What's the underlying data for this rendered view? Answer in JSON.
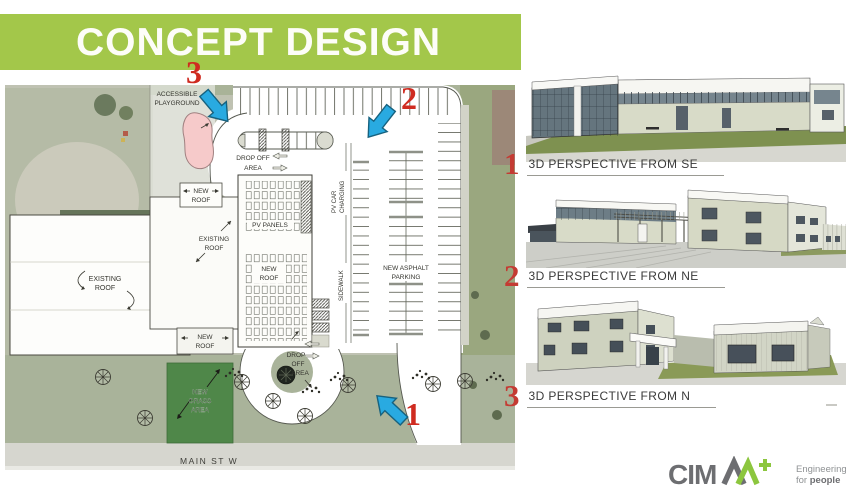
{
  "slide": {
    "title": "CONCEPT DESIGN"
  },
  "site_plan": {
    "street_label": "MAIN ST W",
    "labels": {
      "accessible_playground": [
        "ACCESSIBLE",
        "PLAYGROUND"
      ],
      "drop_off_top": [
        "DROP OFF",
        "AREA"
      ],
      "new_roof_top": [
        "NEW",
        "ROOF"
      ],
      "existing_roof_upper": [
        "EXISTING",
        "ROOF"
      ],
      "existing_roof_main": [
        "EXISTING",
        "ROOF"
      ],
      "pv_panels": "PV PANELS",
      "new_roof_center": [
        "NEW",
        "ROOF"
      ],
      "pv_car_charging": [
        "PV CAR",
        "CHARGING"
      ],
      "sidewalk": "SIDEWALK",
      "new_asphalt_parking": [
        "NEW ASPHALT",
        "PARKING"
      ],
      "new_roof_bottom": [
        "NEW",
        "ROOF"
      ],
      "drop_off_bottom": [
        "DROP",
        "OFF",
        "AREA"
      ],
      "new_grass_area": [
        "NEW",
        "GRASS",
        "AREA"
      ]
    },
    "markers": {
      "one": "1",
      "two": "2",
      "three": "3"
    }
  },
  "perspectives": [
    {
      "number": "1",
      "label": "3D PERSPECTIVE FROM SE"
    },
    {
      "number": "2",
      "label": "3D PERSPECTIVE FROM NE"
    },
    {
      "number": "3",
      "label": "3D PERSPECTIVE FROM N"
    }
  ],
  "branding": {
    "logo_text": "CIM",
    "logo_plus": "+",
    "tagline_line1": "Engineering",
    "tagline_line2_prefix": "for ",
    "tagline_line2_bold": "people"
  },
  "colors": {
    "banner_green": "#a3c74a",
    "marker_red": "#cf2b20",
    "arrow_blue": "#29aae1",
    "grass_green": "#4f8749",
    "playground_pink": "#f6caca",
    "logo_grey": "#6d6e71",
    "logo_green": "#8cc63e"
  }
}
